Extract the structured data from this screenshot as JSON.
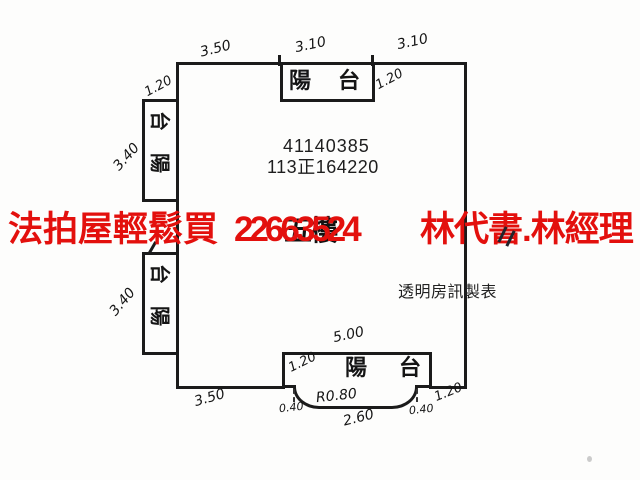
{
  "watermark": {
    "left_text": "法拍屋輕鬆買",
    "phone": "22663524",
    "right_text": "林代書.林經理",
    "color": "#e3100d"
  },
  "plan": {
    "building_number": "41140385",
    "case_number": "113正164220",
    "floor_label": "五樓",
    "credit_label": "透明房訊製表",
    "balconies": {
      "top": {
        "chars": [
          "陽",
          "台"
        ]
      },
      "left_upper": {
        "chars": [
          "台",
          "陽"
        ]
      },
      "left_lower": {
        "chars": [
          "台",
          "陽"
        ]
      },
      "bottom": {
        "chars": [
          "陽",
          "台"
        ]
      }
    },
    "dimensions": {
      "top_left": "3.50",
      "top_middle": "3.10",
      "top_right": "3.10",
      "top_balcony_depth": "1.20",
      "left_upper_balcony_width": "1.20",
      "left_upper_balcony_length": "3.40",
      "left_lower_balcony_length": "3.40",
      "bottom_balcony_width": "5.00",
      "bottom_balcony_depth": "1.20",
      "bottom_left": "3.50",
      "bottom_right": "1.20",
      "curve_radius": "R0.80",
      "curve_width": "2.60",
      "curve_side_left": "0.40",
      "curve_side_right": "0.40"
    }
  }
}
